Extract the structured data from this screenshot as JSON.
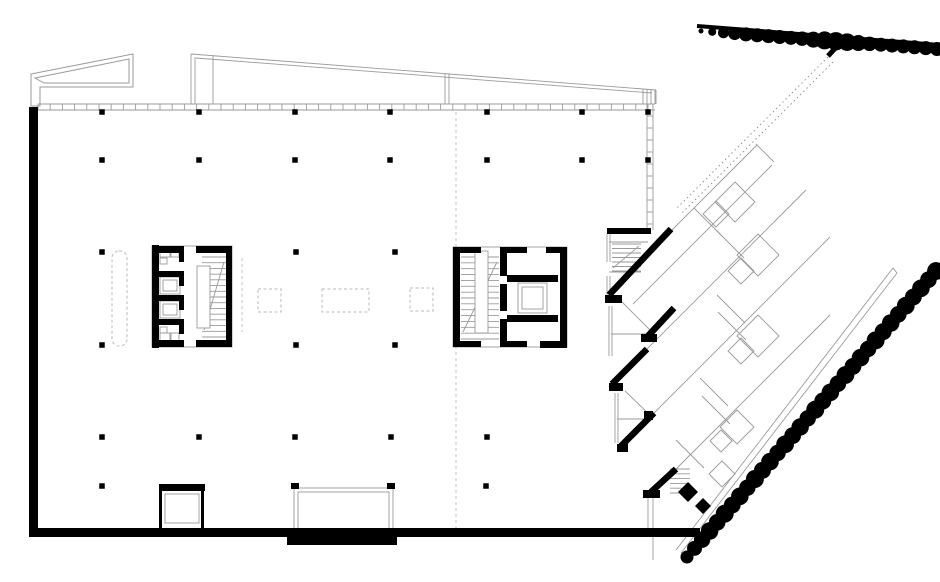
{
  "document": {
    "kind": "architectural-floor-plan",
    "background": "#ffffff"
  },
  "colors": {
    "wall": "#000000",
    "thin": "#9a9a9a",
    "dashed": "#c6c6c6",
    "dotted": "#8a8a8a",
    "tree": "#000000"
  },
  "plan": {
    "canvas": {
      "w": 940,
      "h": 582
    },
    "walls": [
      [
        29,
        107,
        9,
        430
      ],
      [
        29,
        528,
        671,
        9
      ],
      [
        287,
        535,
        110,
        10
      ],
      [
        159,
        484,
        46,
        7
      ],
      [
        159,
        489,
        3,
        40
      ],
      [
        201,
        489,
        3,
        40
      ],
      [
        291,
        483,
        8,
        6
      ],
      [
        387,
        483,
        8,
        6
      ],
      [
        607,
        228,
        44,
        6
      ],
      [
        152,
        245,
        7,
        103
      ],
      [
        152,
        246,
        32,
        7
      ],
      [
        196,
        246,
        36,
        7
      ],
      [
        226,
        246,
        6,
        101
      ],
      [
        152,
        340,
        32,
        7
      ],
      [
        196,
        340,
        36,
        7
      ],
      [
        152,
        271,
        32,
        6
      ],
      [
        152,
        295,
        32,
        6
      ],
      [
        152,
        319,
        32,
        6
      ],
      [
        179,
        253,
        5,
        9
      ],
      [
        179,
        277,
        5,
        9
      ],
      [
        179,
        301,
        5,
        9
      ],
      [
        179,
        325,
        5,
        9
      ],
      [
        453,
        247,
        7,
        100
      ],
      [
        453,
        247,
        28,
        6
      ],
      [
        453,
        341,
        28,
        6
      ],
      [
        500,
        247,
        7,
        29
      ],
      [
        500,
        284,
        7,
        27
      ],
      [
        500,
        319,
        7,
        28
      ],
      [
        500,
        247,
        27,
        6
      ],
      [
        500,
        341,
        27,
        6
      ],
      [
        507,
        275,
        51,
        7
      ],
      [
        507,
        315,
        51,
        7
      ],
      [
        560,
        247,
        7,
        100
      ],
      [
        546,
        247,
        21,
        6
      ],
      [
        540,
        341,
        27,
        7
      ],
      [
        605,
        295,
        17,
        8
      ],
      [
        641,
        334,
        16,
        8
      ],
      [
        609,
        383,
        14,
        8
      ],
      [
        617,
        444,
        11,
        8
      ],
      [
        643,
        490,
        17,
        8
      ],
      [
        644,
        411,
        9,
        9
      ]
    ],
    "diag_bars": [
      [
        671,
        229,
        609,
        295,
        6.5
      ],
      [
        674,
        308,
        648,
        336,
        6.5
      ],
      [
        647,
        349,
        612,
        384,
        6.5
      ],
      [
        654,
        413,
        621,
        446,
        6.5
      ],
      [
        676,
        469,
        651,
        492,
        6.5
      ],
      [
        840,
        43,
        828,
        56,
        5
      ]
    ],
    "columns": {
      "size": 5.5,
      "rows": [
        {
          "y": 112,
          "xs": [
            102,
            199,
            295,
            390,
            487,
            582,
            648
          ]
        },
        {
          "y": 160,
          "xs": [
            102,
            199,
            295,
            390,
            487,
            582,
            648
          ]
        },
        {
          "y": 252,
          "xs": [
            102,
            296,
            395
          ]
        },
        {
          "y": 345,
          "xs": [
            102,
            296,
            395
          ]
        },
        {
          "y": 437,
          "xs": [
            102,
            199,
            295,
            391,
            487
          ]
        },
        {
          "y": 486,
          "xs": [
            102,
            486
          ]
        }
      ]
    },
    "wedge_polys": [
      "31,74 133,54 133,87 40,87 40,106 31,106",
      "35,78 129,59 129,83 44,83"
    ],
    "lines_thin": [
      [
        38,
        104,
        655,
        104
      ],
      [
        38,
        110,
        655,
        110
      ],
      [
        647,
        104,
        647,
        230
      ],
      [
        653,
        104,
        653,
        230
      ],
      [
        191,
        54,
        656,
        90
      ],
      [
        196,
        58,
        652,
        93
      ],
      [
        191,
        54,
        191,
        104
      ],
      [
        195,
        57,
        195,
        104
      ],
      [
        213,
        56,
        213,
        104
      ],
      [
        445,
        74,
        445,
        104
      ],
      [
        449,
        74,
        449,
        104
      ],
      [
        643,
        89,
        643,
        104
      ],
      [
        647,
        89,
        647,
        104
      ],
      [
        651,
        90,
        651,
        104
      ],
      [
        655,
        90,
        655,
        104
      ],
      [
        656,
        90,
        656,
        104
      ],
      [
        204,
        330,
        224,
        262
      ],
      [
        463,
        332,
        497,
        262
      ],
      [
        613,
        268,
        639,
        246
      ],
      [
        607,
        234,
        607,
        262
      ],
      [
        610,
        234,
        610,
        262
      ],
      [
        607,
        276,
        607,
        296
      ],
      [
        610,
        276,
        610,
        296
      ],
      [
        609,
        242,
        648,
        242
      ],
      [
        609,
        272,
        641,
        272
      ],
      [
        609,
        306,
        609,
        356
      ],
      [
        612,
        306,
        612,
        356
      ],
      [
        611,
        334,
        647,
        334
      ],
      [
        621,
        301,
        650,
        330
      ],
      [
        615,
        393,
        615,
        443
      ],
      [
        618,
        393,
        618,
        443
      ],
      [
        617,
        419,
        647,
        419
      ],
      [
        625,
        391,
        653,
        418
      ],
      [
        648,
        495,
        648,
        528
      ],
      [
        653,
        495,
        653,
        528
      ],
      [
        653,
        537,
        653,
        560
      ],
      [
        612,
        290,
        757,
        145
      ],
      [
        633,
        304,
        772,
        165
      ],
      [
        625,
        371,
        806,
        190
      ],
      [
        640,
        427,
        830,
        237
      ],
      [
        662,
        483,
        830,
        315
      ],
      [
        756,
        144,
        774,
        162
      ],
      [
        694,
        208,
        722,
        236
      ],
      [
        716,
        230,
        744,
        258
      ],
      [
        717,
        295,
        745,
        323
      ],
      [
        718,
        312,
        746,
        340
      ],
      [
        700,
        378,
        728,
        406
      ],
      [
        702,
        396,
        730,
        424
      ],
      [
        676,
        440,
        704,
        468
      ],
      [
        676,
        550,
        893,
        268
      ],
      [
        681,
        553,
        897,
        273
      ],
      [
        893,
        268,
        897,
        273
      ]
    ],
    "rects_outline": [
      [
        152,
        246,
        80,
        101
      ],
      [
        453,
        247,
        114,
        100
      ],
      [
        165,
        494,
        34,
        29
      ],
      [
        294,
        488,
        99,
        41
      ],
      [
        298,
        492,
        91,
        37
      ],
      [
        160,
        277,
        20,
        17
      ],
      [
        163,
        280,
        14,
        11
      ],
      [
        160,
        301,
        20,
        17
      ],
      [
        163,
        304,
        14,
        11
      ],
      [
        518,
        283,
        29,
        30
      ],
      [
        522,
        287,
        21,
        22
      ],
      [
        160,
        249,
        10,
        8
      ],
      [
        171,
        249,
        8,
        8
      ],
      [
        160,
        258,
        7,
        6
      ],
      [
        160,
        333,
        10,
        8
      ],
      [
        171,
        333,
        8,
        8
      ],
      [
        160,
        327,
        7,
        6
      ]
    ],
    "white_rects": [
      [
        197,
        266,
        13,
        62
      ],
      [
        475,
        251,
        13,
        82
      ]
    ],
    "stairs": [
      {
        "x": 612,
        "y": 244,
        "w": 29,
        "h": 27,
        "n": 7
      },
      {
        "x": 202,
        "y": 257,
        "w": 24,
        "h": 80,
        "n": 15
      },
      {
        "x": 461,
        "y": 257,
        "w": 38,
        "h": 82,
        "n": 15
      },
      {
        "x": 670,
        "y": 469,
        "w": 20,
        "h": 24,
        "n": 6
      }
    ],
    "ticks": [
      {
        "dir": "h",
        "x": 38,
        "y": 104,
        "len": 617,
        "step": 12.2,
        "t": 6
      },
      {
        "dir": "v",
        "x": 647,
        "y": 116,
        "len": 114,
        "step": 12,
        "t": 6
      }
    ],
    "dashed_lines": [
      [
        456,
        112,
        456,
        528
      ],
      [
        242,
        258,
        242,
        332
      ]
    ],
    "dashed_rects": [
      [
        112,
        251,
        15,
        95,
        7
      ],
      [
        258,
        289,
        23,
        23,
        0
      ],
      [
        322,
        289,
        47,
        23,
        0
      ],
      [
        410,
        288,
        23,
        23,
        0
      ]
    ],
    "dotted_lines": [
      [
        828,
        57,
        676,
        209
      ],
      [
        833,
        62,
        681,
        214
      ]
    ],
    "diamonds": [
      [
        735,
        202,
        20
      ],
      [
        716,
        214,
        13
      ],
      [
        758,
        255,
        21
      ],
      [
        741,
        271,
        13
      ],
      [
        758,
        336,
        21
      ],
      [
        741,
        351,
        13
      ],
      [
        737,
        427,
        17
      ],
      [
        721,
        441,
        11
      ],
      [
        722,
        474,
        13
      ]
    ],
    "diamonds_filled": [
      [
        688,
        492,
        10
      ],
      [
        703,
        506,
        8
      ]
    ],
    "tree_rows": [
      {
        "name": "tree-row-upper",
        "x1": 701,
        "y1": 31,
        "x2": 937,
        "y2": 49,
        "spine": [
          697,
          26,
          940,
          45,
          4
        ],
        "radii": [
          2.5,
          4,
          5.5,
          6.5,
          7,
          7,
          7,
          7,
          7,
          7.2,
          8,
          9,
          9.2,
          8.8,
          8,
          7.2,
          7,
          7,
          7,
          7,
          7,
          7
        ]
      },
      {
        "name": "tree-row-lower",
        "x1": 687,
        "y1": 557,
        "x2": 936,
        "y2": 271,
        "spine": null,
        "radii": [
          6.5,
          7.5,
          8.2,
          8.8,
          8.3,
          9,
          8.4,
          8.8,
          8.2,
          9,
          8.5,
          8.8,
          8.2,
          8.9,
          8.4,
          8.7,
          8.2,
          9,
          8.5,
          8.8,
          8.3,
          8.9,
          8.4,
          8.8,
          8.2,
          9,
          8.5,
          8.8,
          8.3,
          8.9,
          8.4,
          8.8,
          8.3,
          8.9
        ]
      }
    ]
  }
}
